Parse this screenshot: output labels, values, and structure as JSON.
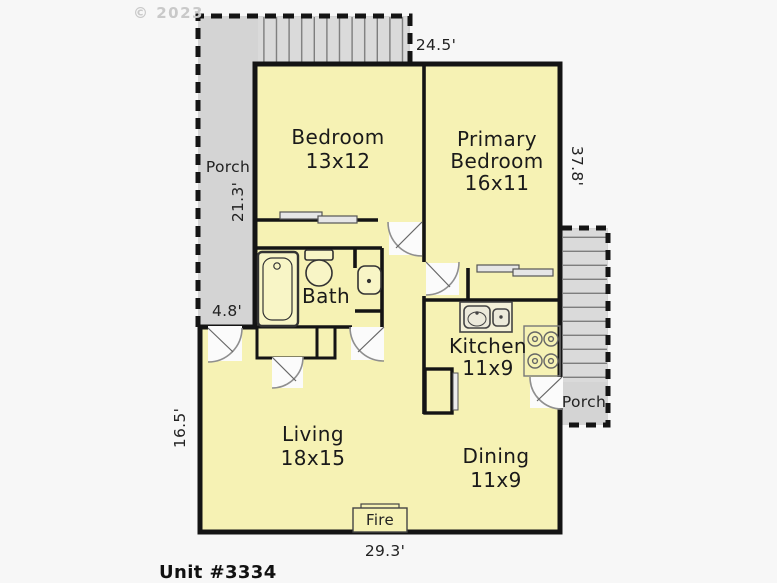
{
  "meta": {
    "watermark": "© 2023",
    "unit_label": "Unit #3334"
  },
  "rooms": {
    "bedroom": {
      "name": "Bedroom",
      "size": "13x12"
    },
    "primary_bedroom": {
      "name": "Primary Bedroom",
      "size": "16x11"
    },
    "bath": {
      "name": "Bath"
    },
    "kitchen": {
      "name": "Kitchen",
      "size": "11x9"
    },
    "living": {
      "name": "Living",
      "size": "18x15"
    },
    "dining": {
      "name": "Dining",
      "size": "11x9"
    }
  },
  "outdoor": {
    "porch_left_label": "Porch",
    "porch_right_label": "Porch"
  },
  "fixtures": {
    "fireplace_label": "Fire"
  },
  "dimensions": {
    "top_width": "24.5'",
    "right_height": "37.8'",
    "porch_left_length": "21.3'",
    "porch_left_width": "4.8'",
    "living_height": "16.5'",
    "bottom_width": "29.3'"
  },
  "colors": {
    "room_fill": "#f6f2b4",
    "porch_fill": "#d4d4d4",
    "stair_fill": "#dadada",
    "wall": "#141414"
  }
}
